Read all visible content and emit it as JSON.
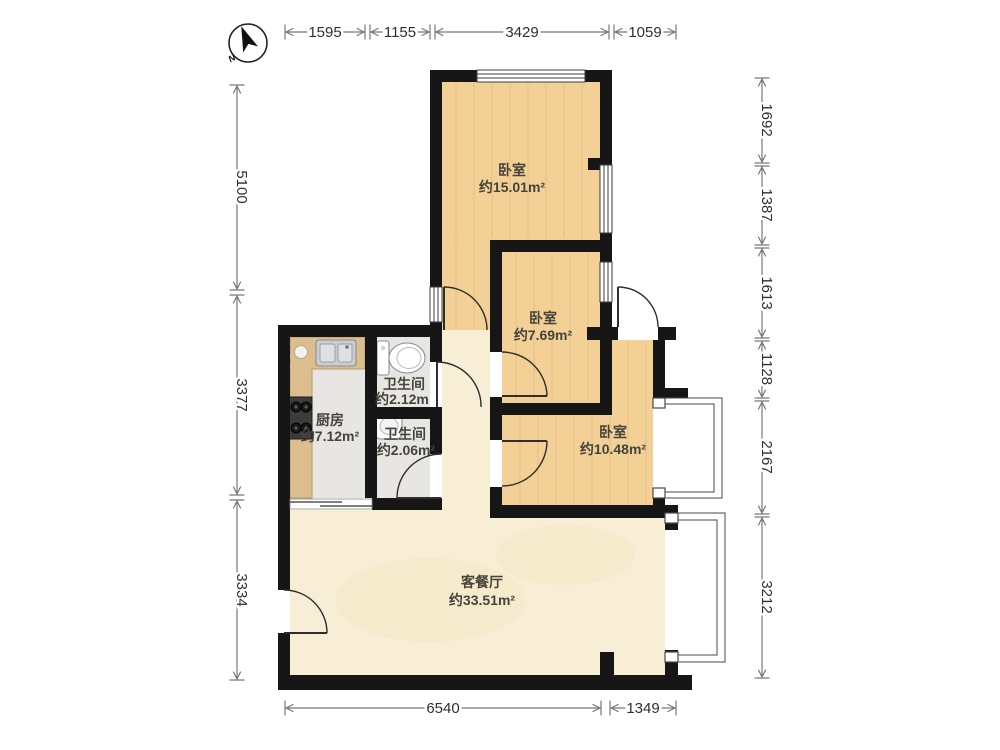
{
  "compass": {
    "north_label": "N"
  },
  "rooms": [
    {
      "id": "bedroom-top",
      "name": "卧室",
      "area": "约15.01m²"
    },
    {
      "id": "bedroom-middle",
      "name": "卧室",
      "area": "约7.69m²"
    },
    {
      "id": "bedroom-right",
      "name": "卧室",
      "area": "约10.48m²"
    },
    {
      "id": "bathroom-1",
      "name": "卫生间",
      "area": "约2.12m"
    },
    {
      "id": "bathroom-2",
      "name": "卫生间",
      "area": "约2.06m²"
    },
    {
      "id": "kitchen",
      "name": "厨房",
      "area": "约7.12m²"
    },
    {
      "id": "living-dining",
      "name": "客餐厅",
      "area": "约33.51m²"
    }
  ],
  "dimensions": {
    "top": [
      "1595",
      "1155",
      "3429",
      "1059"
    ],
    "right": [
      "1692",
      "1387",
      "1613",
      "1128",
      "2167",
      "3212"
    ],
    "left": [
      "5100",
      "3377",
      "3334"
    ],
    "bottom": [
      "6540",
      "1349"
    ]
  },
  "colors": {
    "wall": "#161616",
    "wood_floor": "#f2d096",
    "tile_floor": "#e8e6e3",
    "marble_floor": "#f8eed6",
    "counter": "#dcbd8e",
    "dim_line": "#787878",
    "label_text": "#45443c"
  }
}
